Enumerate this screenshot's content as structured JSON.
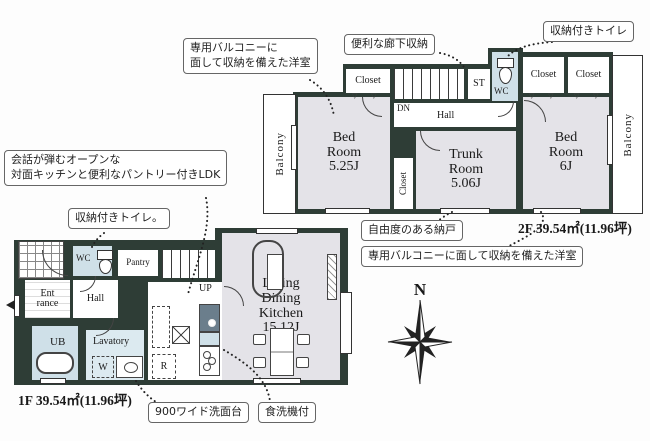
{
  "callouts": {
    "balcony_room_2f": "専用バルコニーに\n面して収納を備えた洋室",
    "hallway_storage": "便利な廊下収納",
    "toilet_storage_2f": "収納付きトイレ",
    "ldk_open_kitchen": "会話が弾むオープンな\n対面キッチンと便利なパントリー付きLDK",
    "toilet_storage_1f": "収納付きトイレ。",
    "flexible_storage": "自由度のある納戸",
    "balcony_room_6j": "専用バルコニーに面して収納を備えた洋室",
    "wide_washstand": "900ワイド洗面台",
    "dishwasher": "食洗機付"
  },
  "floor2": {
    "area_label": "2F 39.54㎡(11.96坪)",
    "rooms": {
      "balcony_left": "Balcony",
      "balcony_right": "Balcony",
      "bedroom_525": "Bed\nRoom\n5.25J",
      "closet_top": "Closet",
      "stairs_dn": "DN",
      "hall": "Hall",
      "st": "ST",
      "wc": "WC",
      "closet_right1": "Closet",
      "closet_right2": "Closet",
      "closet_side": "Closet",
      "trunk": "Trunk\nRoom\n5.06J",
      "bedroom_6": "Bed\nRoom\n6J"
    }
  },
  "floor1": {
    "area_label": "1F 39.54㎡(11.96坪)",
    "rooms": {
      "entrance": "Ent\nrance",
      "wc": "WC",
      "pantry": "Pantry",
      "stairs_up": "UP",
      "hall": "Hall",
      "ub": "UB",
      "lavatory": "Lavatory",
      "washer": "W",
      "fridge": "R",
      "ldk": "Living\nDining\nKitchen\n15.12J"
    }
  },
  "compass": {
    "north": "N"
  },
  "icons": {
    "hanger_marks": "▽ ▽"
  },
  "colors": {
    "wall": "#2e3d36",
    "room_floor": "#e4e3e8",
    "wet_area": "#cfe0e8"
  }
}
